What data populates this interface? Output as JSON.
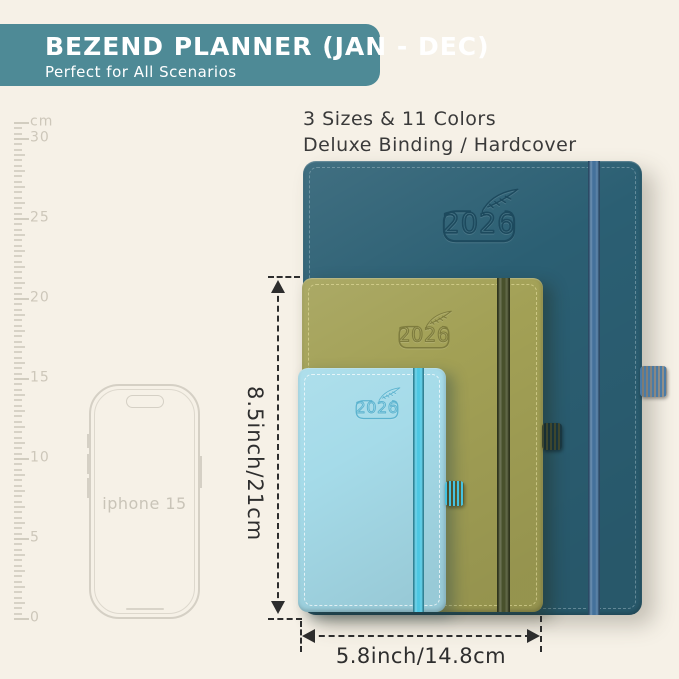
{
  "canvas": {
    "background": "#f6f1e7"
  },
  "header": {
    "title": "BEZEND PLANNER (JAN - DEC)",
    "subtitle": "Perfect for All Scenarios",
    "bg": "#4e8a96"
  },
  "info": {
    "line1": "3 Sizes & 11 Colors",
    "line2": "Deluxe Binding / Hardcover"
  },
  "ruler": {
    "unit": "cm",
    "labels": [
      "30",
      "25",
      "20",
      "15",
      "10",
      "5",
      "0"
    ]
  },
  "phone": {
    "label": "iphone 15"
  },
  "planners": [
    {
      "id": "large-teal",
      "year": "2026",
      "cover": "#2b5f73",
      "band": "#44719b",
      "stitch": "rgba(171,196,205,0.45)",
      "emboss": "#1d4a5e",
      "loop": "#4a7ba6"
    },
    {
      "id": "medium-olive",
      "year": "2026",
      "cover": "#a2a055",
      "band": "#49512c",
      "stitch": "rgba(238,232,170,0.55)",
      "emboss": "#7e7c3e",
      "loop": "#3d462e"
    },
    {
      "id": "small-blue",
      "year": "2026",
      "cover": "#a5dbe9",
      "band": "#4cc7e3",
      "stitch": "rgba(255,255,255,0.7)",
      "emboss": "#5cb3cf",
      "loop": "#45c2e0"
    }
  ],
  "dimensions": {
    "height_label": "8.5inch/21cm",
    "width_label": "5.8inch/14.8cm"
  }
}
